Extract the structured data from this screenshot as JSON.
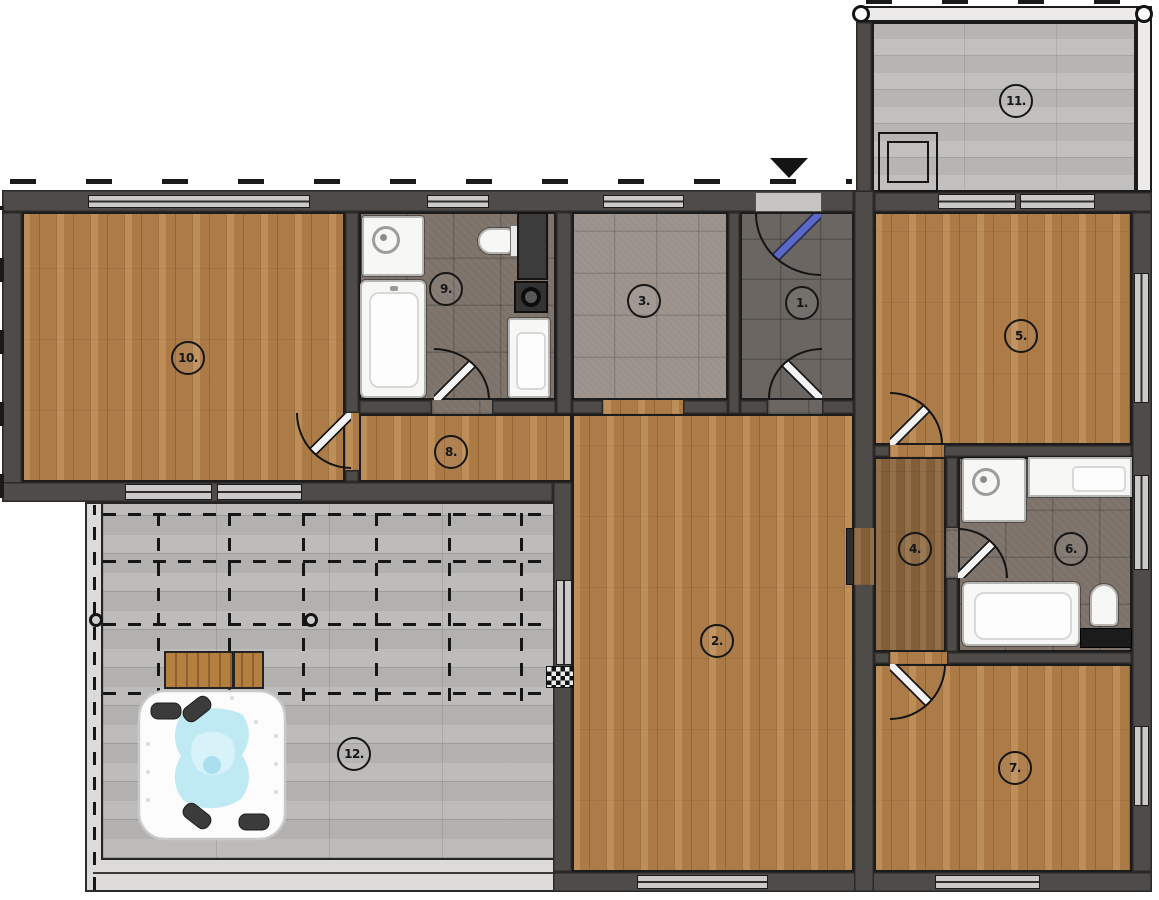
{
  "plan": {
    "type": "floor-plan",
    "rooms": [
      {
        "label": "1."
      },
      {
        "label": "2."
      },
      {
        "label": "3."
      },
      {
        "label": "4."
      },
      {
        "label": "5."
      },
      {
        "label": "6."
      },
      {
        "label": "7."
      },
      {
        "label": "8."
      },
      {
        "label": "9."
      },
      {
        "label": "10."
      },
      {
        "label": "11."
      },
      {
        "label": "12."
      }
    ],
    "colors": {
      "wall": "#4e4b49",
      "wood_floor": "#b5824c",
      "wood_floor_dark": "#8a6640",
      "tile_dark": "#7c7269",
      "tile_entry": "#6b6662",
      "tile_light": "#9a918a",
      "terrace_paver": "#b8b7b5",
      "balcony_paver": "#bcbbb9",
      "hot_tub_water": "#bfe9f3",
      "entry_door_leaf": "#5a68c8",
      "entry_arrow": "#141414"
    },
    "icons": {
      "entry_arrow": "entry-direction-arrow",
      "hot_tub": "hot-tub",
      "bench": "bench",
      "shower": "shower",
      "bathtub": "bathtub",
      "toilet": "toilet",
      "sink": "sink",
      "washing_machine": "washing-machine",
      "tall_cabinet": "tall-cabinet",
      "radiator": "radiator",
      "vanity_counter": "vanity-counter",
      "pergola_post": "pergola-post",
      "railing_post": "railing-post",
      "roof_skylight": "skylight-hatch"
    }
  }
}
